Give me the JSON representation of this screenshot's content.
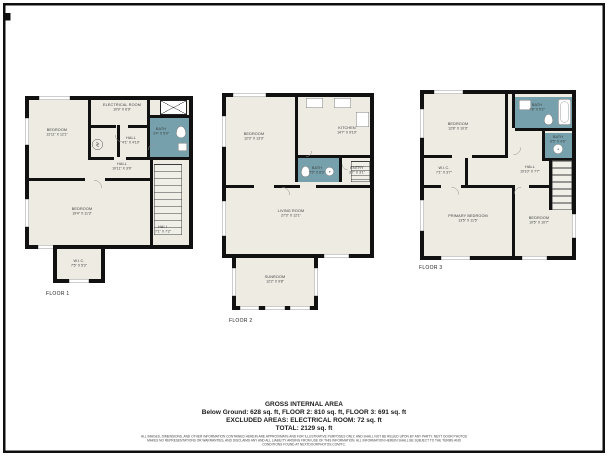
{
  "colors": {
    "background": "#ffffff",
    "wall": "#111111",
    "floor_fill": "#edebe2",
    "bath_fill": "#76a1ac",
    "frame": "#0f0f0f"
  },
  "floors": [
    {
      "label": "FLOOR 1",
      "rooms": [
        {
          "name": "BEDROOM",
          "dims": "12'11\" X 12'1\""
        },
        {
          "name": "ELECTRICAL ROOM",
          "dims": "10'9\" X 6'9\""
        },
        {
          "name": "HALL",
          "dims": "4'1\" X 4'10\""
        },
        {
          "name": "BATH",
          "dims": "3'4\" X 5'9\""
        },
        {
          "name": "HALL",
          "dims": "10'11\" X 3'9\""
        },
        {
          "name": "BEDROOM",
          "dims": "19'4\" X 11'3\""
        },
        {
          "name": "HALL",
          "dims": "7'1\" X 7'2\""
        },
        {
          "name": "W.I.C.",
          "dims": "7'5\" X 5'3\""
        }
      ]
    },
    {
      "label": "FLOOR 2",
      "rooms": [
        {
          "name": "BEDROOM",
          "dims": "12'3\" X 13'3\""
        },
        {
          "name": "KITCHEN",
          "dims": "14'7\" X 9'10\""
        },
        {
          "name": "BATH",
          "dims": "5'5\" X 8'3\""
        },
        {
          "name": "ENTRY",
          "dims": "3'7\" X 3'1\""
        },
        {
          "name": "LIVING ROOM",
          "dims": "27'3\" X 12'1\""
        },
        {
          "name": "SUNROOM",
          "dims": "12'2\" X 9'8\""
        }
      ]
    },
    {
      "label": "FLOOR 3",
      "rooms": [
        {
          "name": "BEDROOM",
          "dims": "12'8\" X 10'3\""
        },
        {
          "name": "BATH",
          "dims": "7'8\" X 5'2\""
        },
        {
          "name": "BATH",
          "dims": "6'5\" X 4'6\""
        },
        {
          "name": "W.I.C.",
          "dims": "7'1\" X 3'7\""
        },
        {
          "name": "HALL",
          "dims": "10'10\" X 7'7\""
        },
        {
          "name": "PRIMARY BEDROOM",
          "dims": "13'5\" X 11'5\""
        },
        {
          "name": "BEDROOM",
          "dims": "10'5\" X 10'7\""
        }
      ]
    }
  ],
  "summary": {
    "title": "GROSS INTERNAL AREA",
    "breakdown": "Below Ground: 628 sq. ft, FLOOR 2: 810 sq. ft, FLOOR 3: 691 sq. ft",
    "excluded": "EXCLUDED AREAS: ELECTRICAL ROOM: 72 sq. ft",
    "total": "TOTAL: 2129 sq. ft",
    "disclaimer": "ALL IMAGES, DIMENSIONS, AND OTHER INFORMATION CONTAINED HEREIN ARE APPROXIMATE AND FOR ILLUSTRATIVE PURPOSES ONLY, AND SHALL NOT BE RELIED UPON BY ANY PARTY. NEXT DOOR PHOTOS MAKES NO REPRESENTATIONS OR WARRANTIES, AND DISCLAIMS ANY AND ALL LIABILITY ARISING FROM USE OF THIS INFORMATION. ALL INFORMATION HEREIN SHALL BE SUBJECT TO THE TERMS AND CONDITIONS FOUND AT NEXTDOORPHOTOS.COM/TC."
  }
}
